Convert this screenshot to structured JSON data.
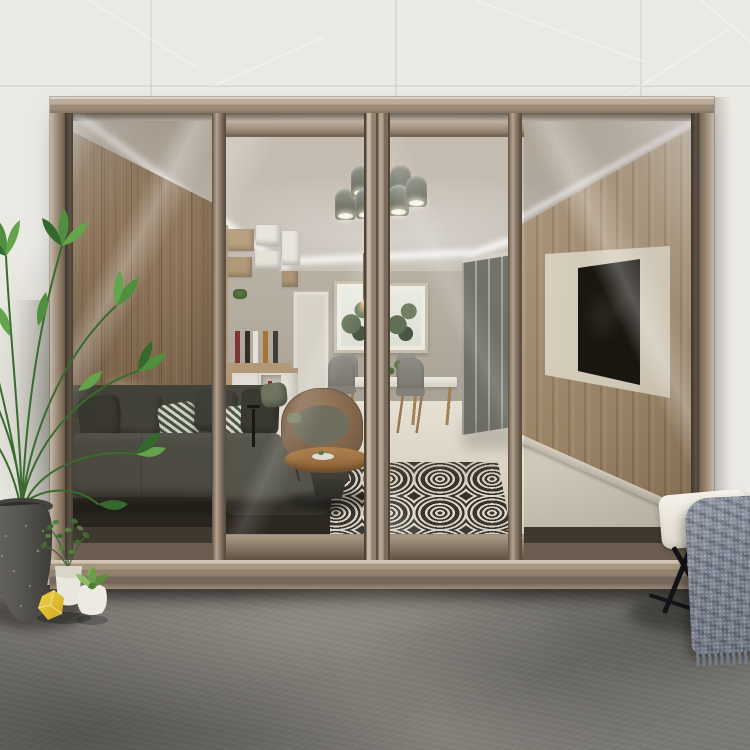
{
  "image_description": "Product photo of a four-panel champagne-bronze aluminium sliding glass door viewed from a dark concrete patio, looking into a modern living and dining room",
  "visible_text": "none",
  "palette": {
    "wall": "#ebe9e3",
    "concrete": "#7a7872",
    "frame-hi": "#d8ccbd",
    "frame-light": "#b5a493",
    "frame-mid": "#94836f",
    "frame-dark": "#5c4f43",
    "ceiling": "#c6beb2",
    "cove": "#ffffff",
    "backwall": "#b6afa2",
    "wood": "#9b8265",
    "shelf-wood": "#b49a79",
    "shelf-white": "#e9e5dc",
    "sofa": "#4b4b41",
    "sofa-dark": "#36362e",
    "rattan": "#8a6c50",
    "tabletop": "#a57e50",
    "rug-dark": "#332e27",
    "rug-light": "#e9e4d6",
    "floor-int": "#e9e3d4",
    "glazing": "#6f6f68",
    "tv": "#14130e",
    "tv-panel": "#ece5d3",
    "tv-wood": "#b49e80",
    "chair": "#8e8d86",
    "stool": "#f0ede4",
    "leg": "#141318",
    "blanket": "#7e8591",
    "plant-dark": "#2f5c26",
    "plant-mid": "#47823a",
    "plant-light": "#63a44c",
    "pot-white": "#e9e6de",
    "pot-stone": "#56544e",
    "gem": "#e9c636",
    "gold": "#c49552",
    "print-mat": "#f4f1e9"
  },
  "scene": {
    "door": {
      "panels": 4,
      "frame_finish": "champagne bronze",
      "glass": "clear"
    },
    "objects": [
      "exterior tile wall",
      "concrete patio floor",
      "palm plant in stone planter",
      "potted bush",
      "succulent pot",
      "yellow faceted ornament",
      "white cushioned stool",
      "gray throw blanket",
      "dark sectional sofa with pillows",
      "rattan armchair",
      "round wood coffee table",
      "black-and-white geometric rug",
      "shelving unit with bottles",
      "two botanical wall prints",
      "dining table with gray chairs",
      "bell chandelier",
      "pendant lights",
      "ceiling cove light",
      "balcony glazing",
      "wood TV wall with mounted television",
      "glossy cream interior floor"
    ]
  }
}
